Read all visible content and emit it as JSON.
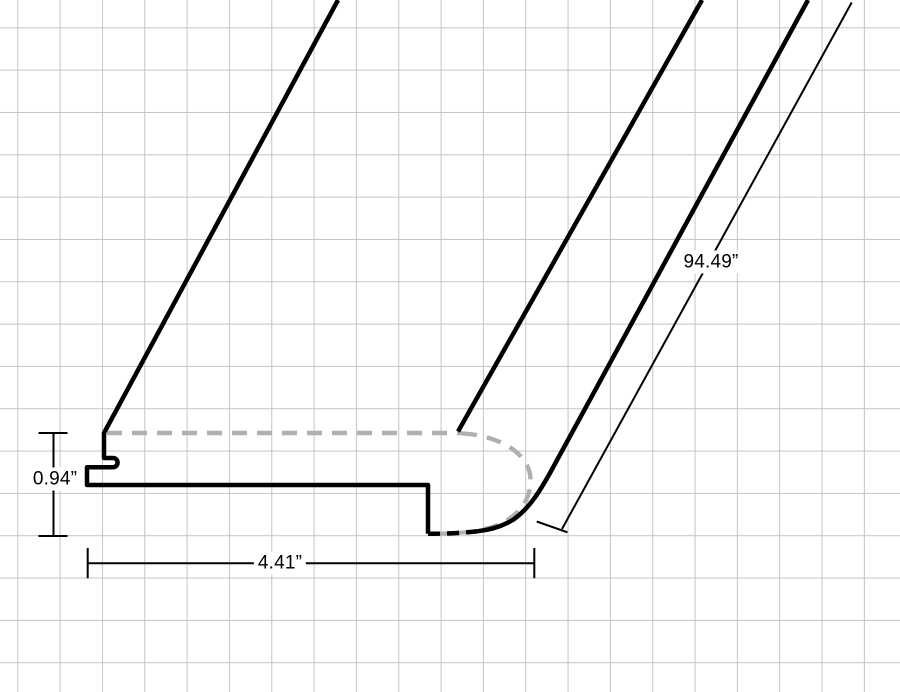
{
  "dimension_labels": {
    "thickness": "0.94”",
    "width": "4.41”",
    "length": "94.49”"
  },
  "colors": {
    "background": "#ffffff",
    "grid_line": "#c4c4c4",
    "profile_line": "#000000",
    "hidden_edge_line": "#b0b0b0",
    "dimension_line": "#000000",
    "label_text": "#000000"
  }
}
